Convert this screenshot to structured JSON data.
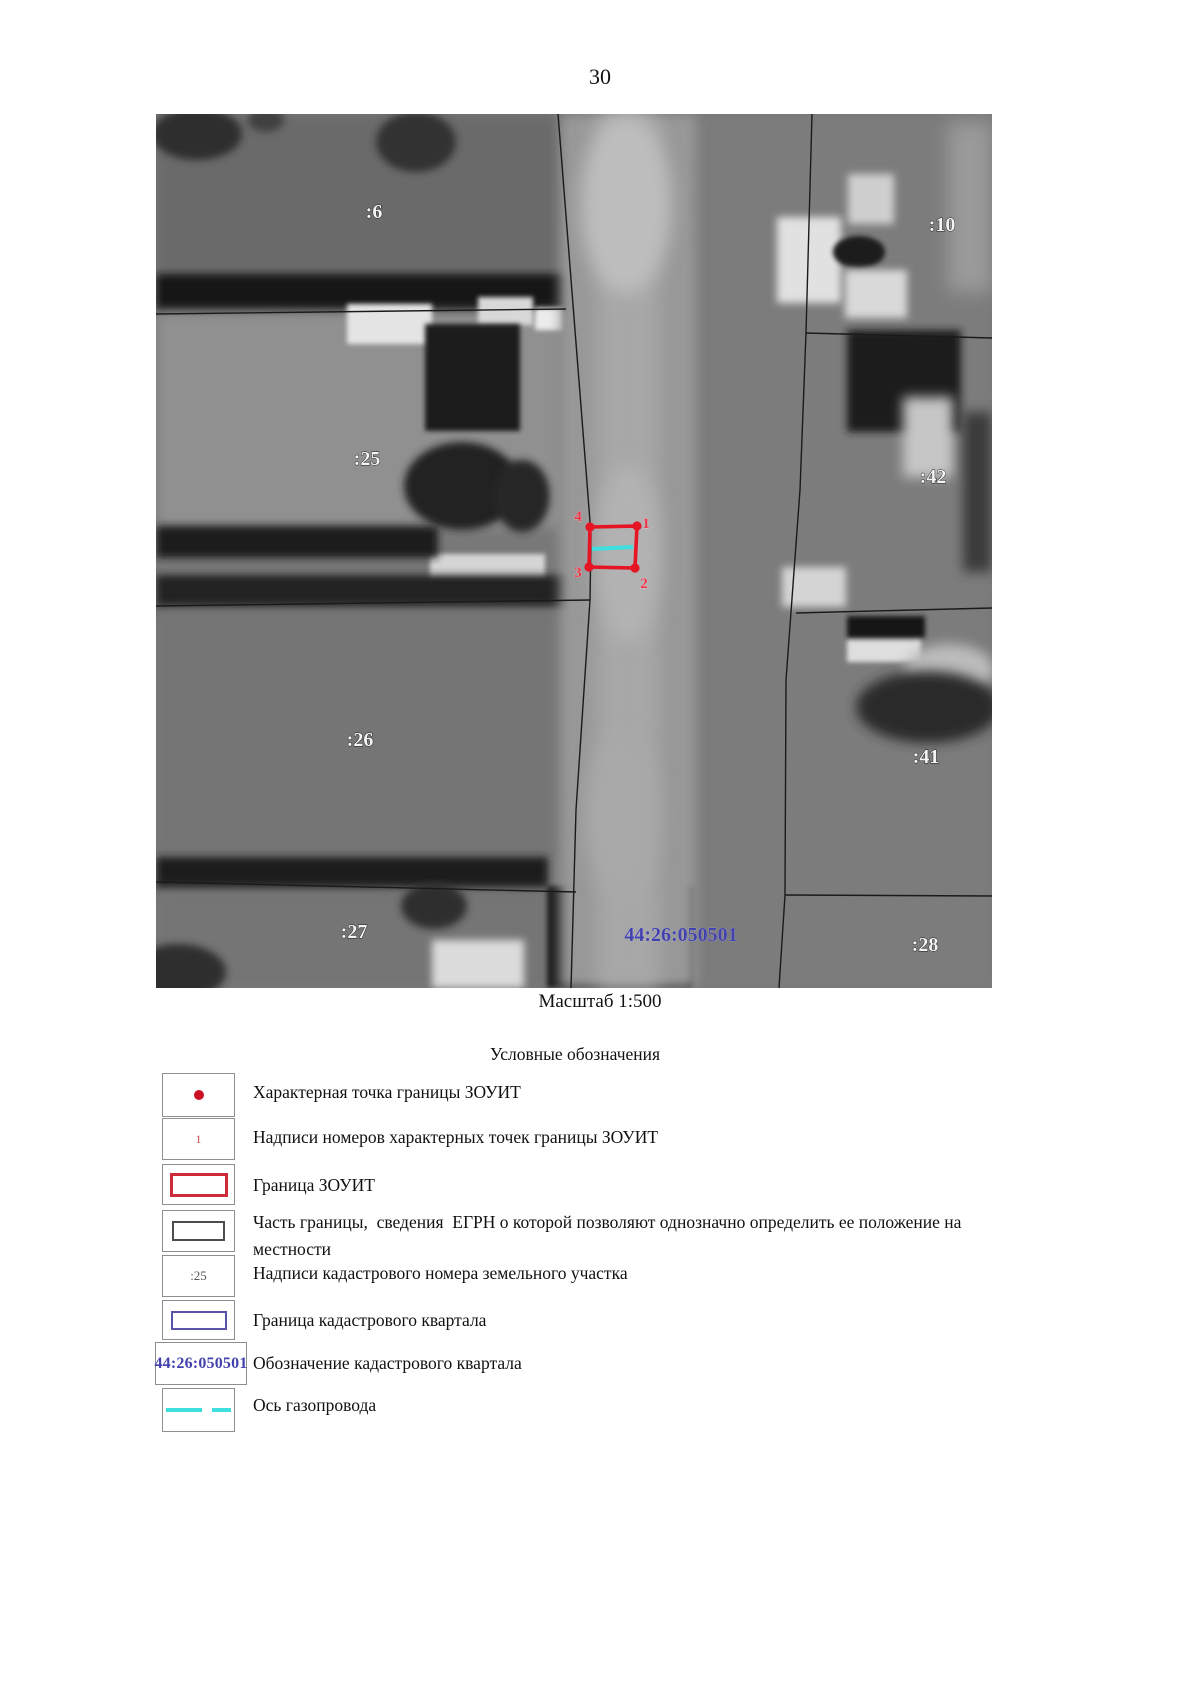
{
  "page": {
    "number": "30"
  },
  "map": {
    "caption": "Масштаб 1:500",
    "cadastral_quarter": "44:26:050501",
    "parcels": [
      {
        "label": ":6"
      },
      {
        "label": ":25"
      },
      {
        "label": ":26"
      },
      {
        "label": ":27"
      },
      {
        "label": ":10"
      },
      {
        "label": ":42"
      },
      {
        "label": ":41"
      },
      {
        "label": ":28"
      }
    ],
    "vertices": [
      {
        "label": "1"
      },
      {
        "label": "2"
      },
      {
        "label": "3"
      },
      {
        "label": "4"
      }
    ]
  },
  "legend": {
    "title": "Условные обозначения",
    "items": [
      {
        "symbol": "red-point-icon",
        "label": "Характерная точка границы ЗОУИТ"
      },
      {
        "symbol": "point-number-icon",
        "symbol_text": "1",
        "label": "Надписи номеров характерных точек границы ЗОУИТ"
      },
      {
        "symbol": "red-rectangle-icon",
        "label": "Граница ЗОУИТ"
      },
      {
        "symbol": "black-rectangle-icon",
        "label": "Часть границы,  сведения  ЕГРН о которой позволяют однозначно определить ее положение на местности"
      },
      {
        "symbol": "parcel-number-icon",
        "symbol_text": ":25",
        "label": "Надписи кадастрового номера земельного участка"
      },
      {
        "symbol": "blue-rectangle-icon",
        "label": "Граница кадастрового квартала"
      },
      {
        "symbol": "quarter-number-icon",
        "symbol_text": "44:26:050501",
        "label": "Обозначение кадастрового квартала"
      },
      {
        "symbol": "cyan-dashed-line-icon",
        "label": "Ось газопровода"
      }
    ]
  },
  "colors": {
    "zouit_red": "#e51524",
    "gas_axis_cyan": "#3fdfdf",
    "quarter_blue": "#4341ae",
    "boundary_black": "#1a1a1a"
  }
}
